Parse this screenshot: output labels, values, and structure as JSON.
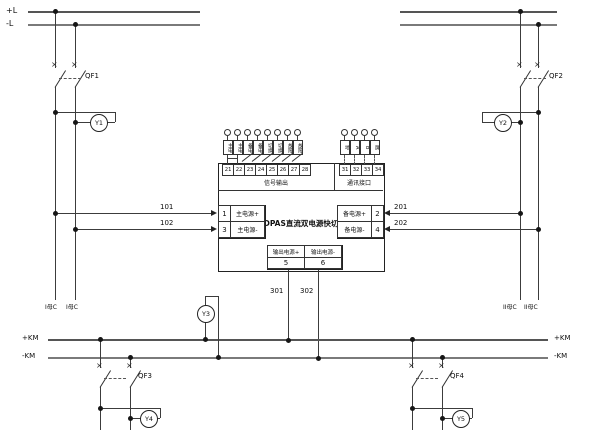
{
  "diagram": {
    "top_bus": {
      "pos_label": "+L",
      "neg_label": "-L"
    },
    "bottom_bus": {
      "pos_label": "+KM",
      "neg_label": "-KM"
    },
    "breakers": {
      "qf1": "QF1",
      "qf2": "QF2",
      "qf3": "QF3",
      "qf4": "QF4"
    },
    "indicators": {
      "y1": "Y1",
      "y2": "Y2",
      "y3": "Y3",
      "y4": "Y4",
      "y5": "Y5"
    },
    "feeders": {
      "left_a": "I母C",
      "left_b": "I母C",
      "right_a": "II母C",
      "right_b": "II母C"
    },
    "wires": {
      "w101": "101",
      "w102": "102",
      "w201": "201",
      "w202": "202",
      "w301": "301",
      "w302": "302"
    },
    "module": {
      "title": "DPAS直流双电源快切",
      "main_input": {
        "t1_num": "1",
        "t1_label": "主电源+",
        "t3_num": "3",
        "t3_label": "主电源-"
      },
      "backup_input": {
        "t2_num": "2",
        "t2_label": "备电源+",
        "t4_num": "4",
        "t4_label": "备电源-"
      },
      "output": {
        "pos_label": "输出电源+",
        "neg_label": "输出电源-",
        "pos_num": "5",
        "neg_num": "6"
      },
      "signal_section": {
        "label": "信号输出",
        "terminals": [
          {
            "num": "21",
            "tag": "主电"
          },
          {
            "num": "22",
            "tag": "主电"
          },
          {
            "num": "23",
            "tag": "备电"
          },
          {
            "num": "24",
            "tag": "备电"
          },
          {
            "num": "25",
            "tag": "切换"
          },
          {
            "num": "26",
            "tag": "切换"
          },
          {
            "num": "27",
            "tag": "故障"
          },
          {
            "num": "28",
            "tag": "故障"
          }
        ]
      },
      "comm_section": {
        "label": "通讯接口",
        "terminals": [
          {
            "num": "31",
            "tag": "地"
          },
          {
            "num": "32",
            "tag": "A"
          },
          {
            "num": "33",
            "tag": "B"
          },
          {
            "num": "34",
            "tag": "屏"
          }
        ]
      }
    }
  }
}
